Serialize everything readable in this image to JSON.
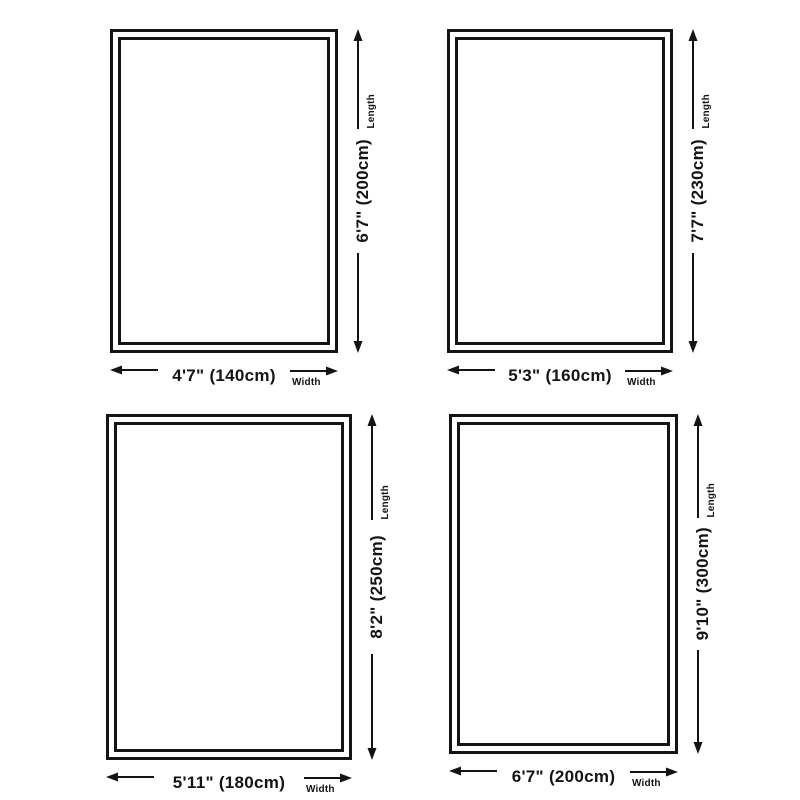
{
  "colors": {
    "ink": "#141414",
    "background": "#ffffff"
  },
  "icons": {
    "arrow_up": "arrow-up-icon",
    "arrow_down": "arrow-down-icon",
    "arrow_left": "arrow-left-icon",
    "arrow_right": "arrow-right-icon"
  },
  "rugs": [
    {
      "length_label": "6'7\" (200cm)",
      "width_label": "4'7\" (140cm)",
      "length_axis": "Length",
      "width_axis": "Width"
    },
    {
      "length_label": "7'7\" (230cm)",
      "width_label": "5'3\" (160cm)",
      "length_axis": "Length",
      "width_axis": "Width"
    },
    {
      "length_label": "8'2\" (250cm)",
      "width_label": "5'11\" (180cm)",
      "length_axis": "Length",
      "width_axis": "Width"
    },
    {
      "length_label": "9'10\" (300cm)",
      "width_label": "6'7\" (200cm)",
      "length_axis": "Length",
      "width_axis": "Width"
    }
  ]
}
